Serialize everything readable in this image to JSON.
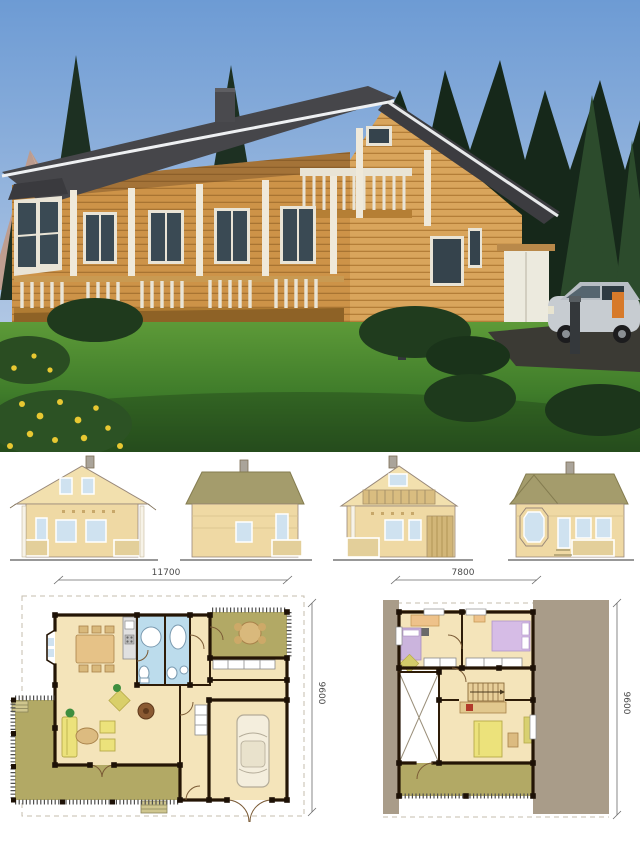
{
  "sheet": {
    "description": "Log house presentation sheet: exterior render, four elevations, ground and upper floor plans",
    "background": "#ffffff"
  },
  "photo": {
    "subject": "two-storey log house with porch, balcony, garage and minivan",
    "sky_color": "#6d9bd4",
    "lawn_color": "#4d8a33",
    "roof_color": "#46464a",
    "log_wall_color": "#cd9348"
  },
  "elevations": {
    "wall_color": "#efd9a4",
    "roof_color": "#a49c6c",
    "window_color": "#cfe2f0"
  },
  "plans": {
    "ground_floor": {
      "width_label": "11700",
      "depth_label": "9600"
    },
    "upper_floor": {
      "width_label": "7800",
      "depth_label": "9600"
    },
    "floor_color": "#f4e4ba",
    "terrace_color": "#b2a965",
    "bathroom_color": "#bcdcec",
    "roof_area_color": "#a99c89",
    "wall_line_color": "#241505"
  }
}
